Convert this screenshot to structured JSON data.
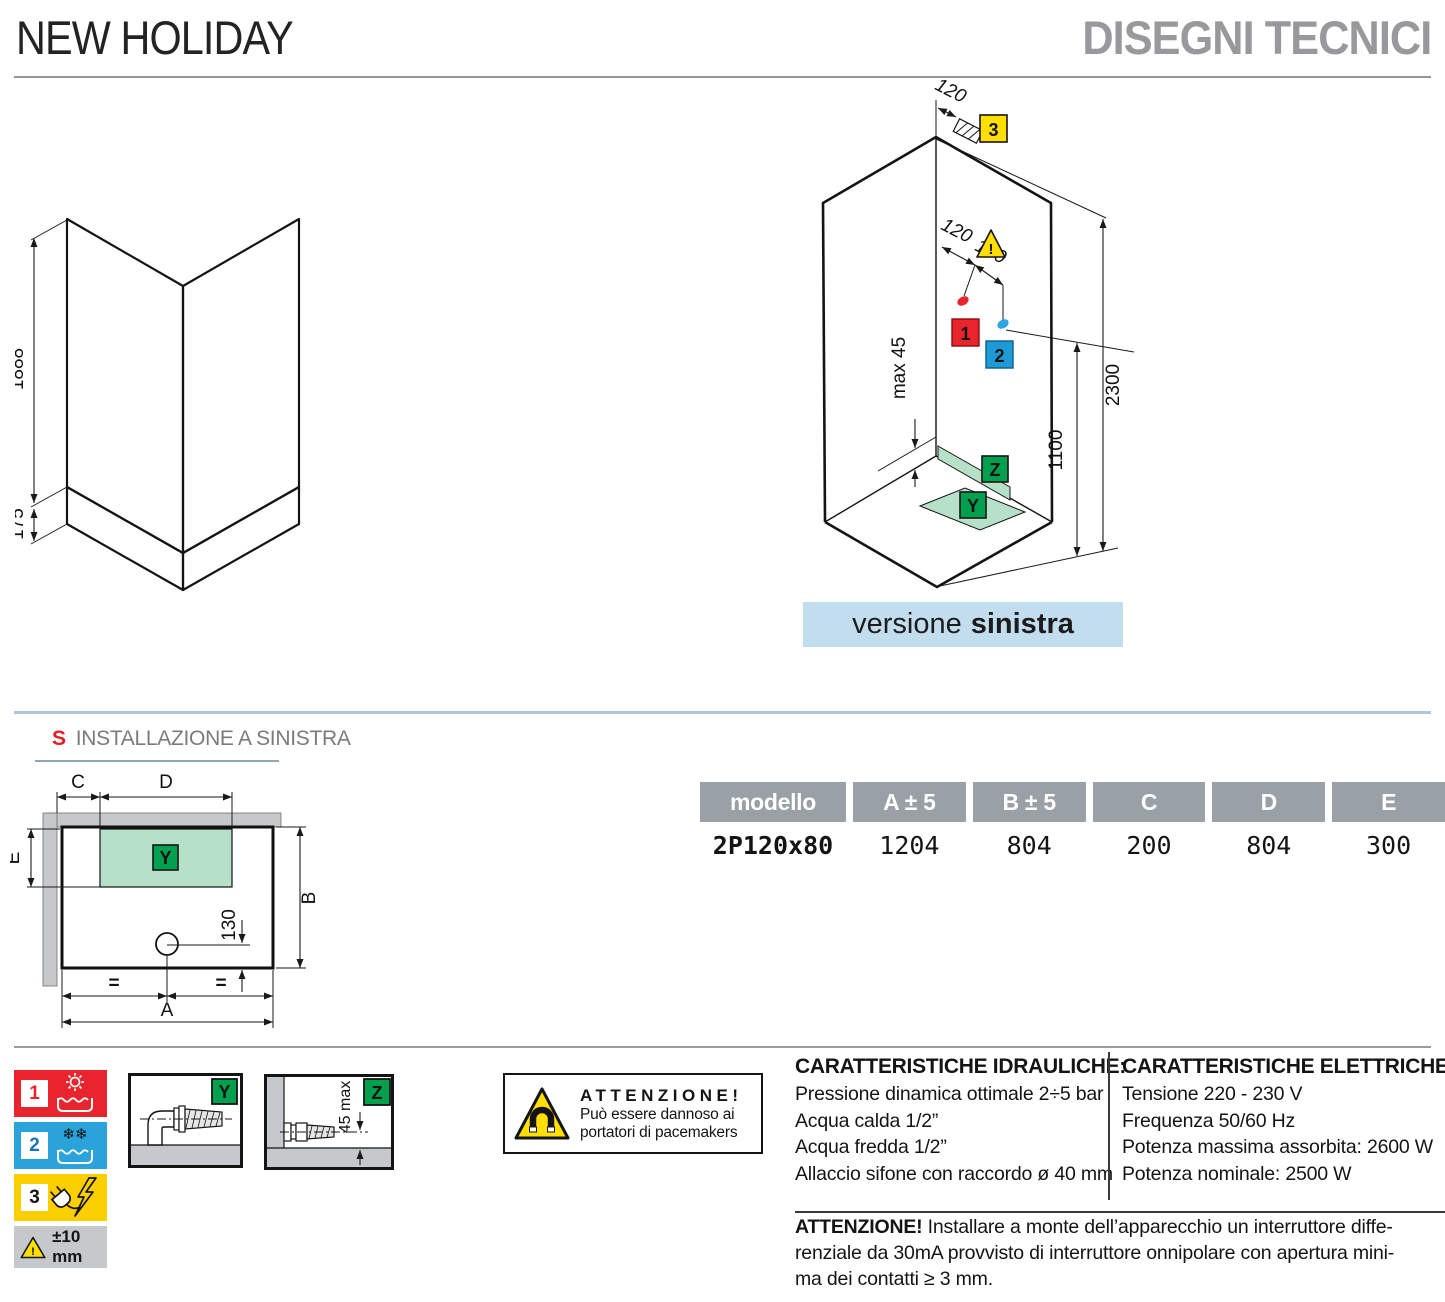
{
  "header": {
    "title": "NEW HOLIDAY",
    "subtitle": "DISEGNI TECNICI"
  },
  "glass_diagram": {
    "dim_glass_height": "1888",
    "dim_tray_height": "175"
  },
  "cabin_diagram": {
    "dim_electric_offset": "120",
    "dim_hot_offset": "120",
    "dim_cold_offset": "100",
    "dim_total_height": "2300",
    "dim_mixer_height": "1100",
    "dim_tray_note": "max 45",
    "marker_hot": "1",
    "marker_cold": "2",
    "marker_electric": "3",
    "marker_drain_zone": "Y",
    "marker_siphon": "Z",
    "warning_mark": "!",
    "caption_regular": "versione",
    "caption_bold": "sinistra"
  },
  "plan": {
    "heading_letter": "S",
    "heading_text": "INSTALLAZIONE A SINISTRA",
    "dim_a": "A",
    "dim_b": "B",
    "dim_c": "C",
    "dim_d": "D",
    "dim_e": "E",
    "dim_drain_offset": "130",
    "equal_mark": "=",
    "marker_drain_zone": "Y"
  },
  "table": {
    "headers": [
      "modello",
      "A ± 5",
      "B ± 5",
      "C",
      "D",
      "E"
    ],
    "row": [
      "2P120x80",
      "1204",
      "804",
      "200",
      "804",
      "300"
    ]
  },
  "legend": {
    "hot_number": "1",
    "cold_number": "2",
    "electric_number": "3",
    "tolerance": "±10 mm",
    "warning_mark": "!"
  },
  "detail_y": {
    "label": "Y"
  },
  "detail_z": {
    "label": "Z",
    "dim": "45 max"
  },
  "magnet_warning": {
    "title": "ATTENZIONE!",
    "line1": "Può essere dannoso ai",
    "line2": "portatori di pacemakers"
  },
  "hydraulics": {
    "title": "CARATTERISTICHE IDRAULICHE:",
    "lines": [
      "Pressione dinamica ottimale 2÷5 bar",
      "Acqua calda 1/2”",
      "Acqua fredda 1/2”",
      "Allaccio sifone con raccordo ø 40 mm"
    ]
  },
  "electrics": {
    "title": "CARATTERISTICHE ELETTRICHE:",
    "lines": [
      "Tensione 220 - 230 V",
      "Frequenza 50/60 Hz",
      "Potenza massima assorbita: 2600 W",
      "Potenza nominale: 2500 W"
    ]
  },
  "footer_warning": {
    "title": "ATTENZIONE!",
    "lines": [
      "Installare a monte dell’apparecchio un interruttore diffe-",
      "renziale da 30mA provvisto di interruttore onnipolare con apertura mini-",
      "ma dei contatti ≥ 3 mm."
    ]
  },
  "icons": {
    "warning_triangle": "warning-triangle-icon",
    "magnet": "magnet-icon",
    "sun": "sun-icon",
    "snowflakes": "❄❄",
    "water": "water-icon",
    "plug": "plug-icon",
    "lightning": "lightning-icon"
  },
  "colors": {
    "accent_red": "#e8252d",
    "accent_blue": "#2aa3da",
    "accent_yellow": "#fccf00",
    "accent_green": "#00a04e",
    "light_green": "#b7e0c9",
    "light_blue_band": "#c2ddee",
    "glass_light": "#cfeaf8",
    "glass_dark": "#a9dcf2",
    "header_gray": "#97999c",
    "table_header_bg": "#9aa1a6",
    "wall_gray": "#c6c9cb"
  }
}
